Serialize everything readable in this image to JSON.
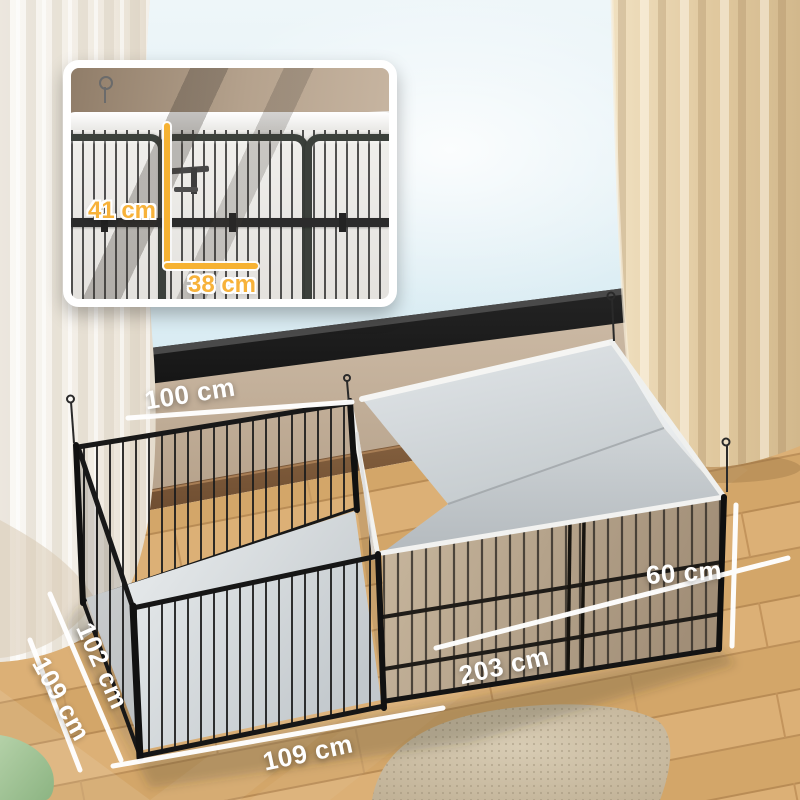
{
  "labels": {
    "top_back": "100 cm",
    "left_inner": "102 cm",
    "left_outer": "109 cm",
    "bottom_front": "109 cm",
    "right_length": "203 cm",
    "right_height": "60 cm"
  },
  "inset": {
    "door_height": "41 cm",
    "door_width": "38 cm"
  },
  "colors": {
    "dimension_text": "#ffffff",
    "inset_accent": "#f6b233"
  }
}
